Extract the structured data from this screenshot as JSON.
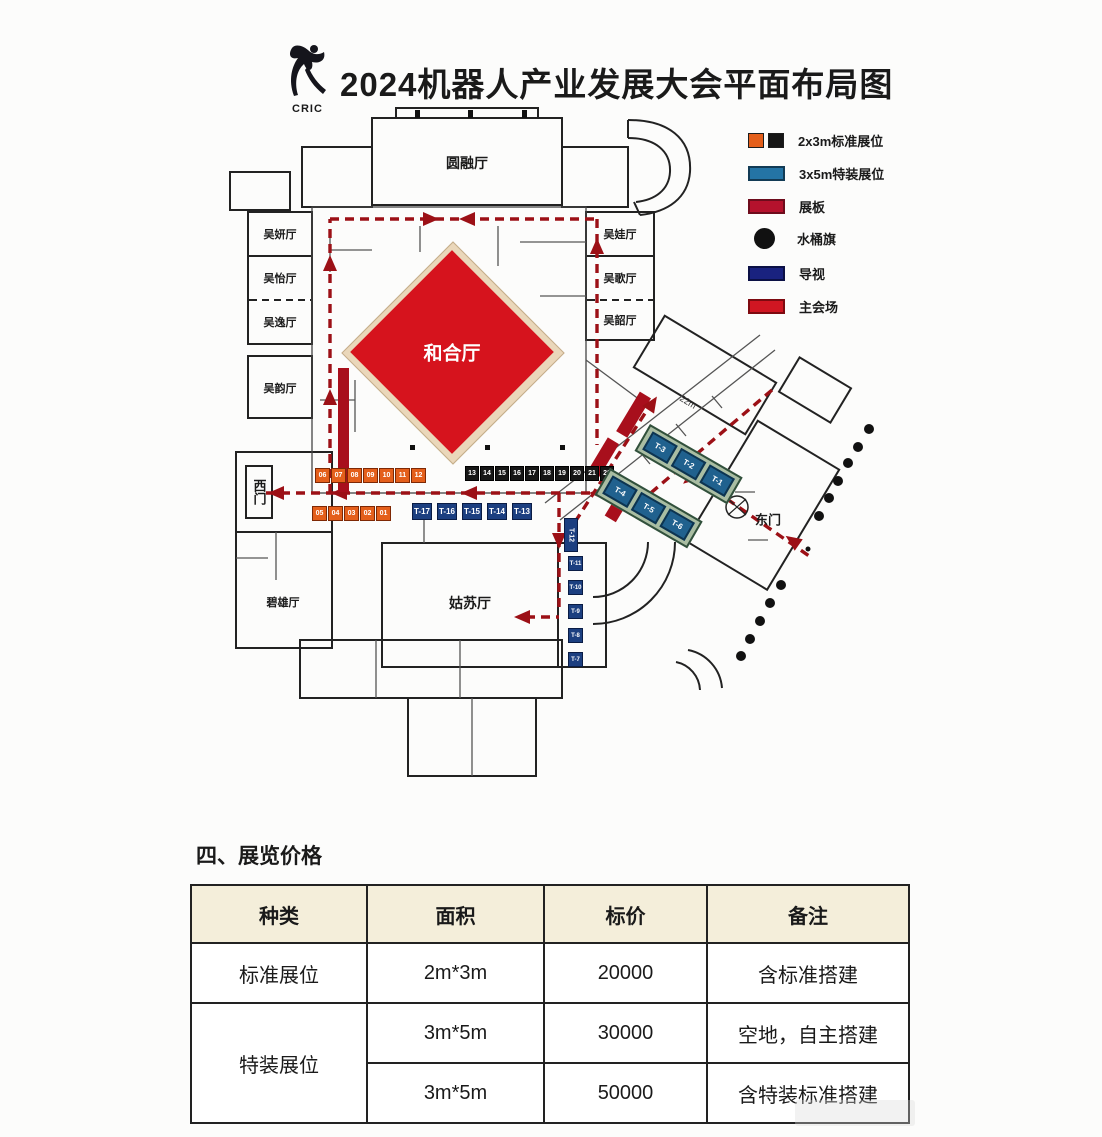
{
  "header": {
    "logo_text": "CRIC",
    "title": "2024机器人产业发展大会平面布局图"
  },
  "legend": {
    "items": [
      {
        "label": "2x3m标准展位",
        "colors": [
          "#e45f1b",
          "#161616"
        ]
      },
      {
        "label": "3x5m特装展位",
        "color": "#2474a5"
      },
      {
        "label": "展板",
        "color": "#b5122d"
      },
      {
        "label": "水桶旗",
        "color": "#111111"
      },
      {
        "label": "导视",
        "color": "#19227f"
      },
      {
        "label": "主会场",
        "color": "#d01622"
      }
    ]
  },
  "floorplan": {
    "rooms": {
      "yuanrong": "圆融厅",
      "hehe": "和合厅",
      "gusu": "姑苏厅",
      "bixiong": "碧雄厅",
      "left": [
        {
          "label": "吴妍厅"
        },
        {
          "label": "吴怡厅"
        },
        {
          "label": "吴逸厅"
        },
        {
          "label": "吴韵厅"
        }
      ],
      "right": [
        {
          "label": "吴娃厅"
        },
        {
          "label": "吴歌厅"
        },
        {
          "label": "吴韶厅"
        }
      ]
    },
    "gates": {
      "west": "西门",
      "east": "东门"
    },
    "booths": {
      "orange_row": [
        "06",
        "07",
        "08",
        "09",
        "10",
        "11",
        "12"
      ],
      "black_row": [
        "13",
        "14",
        "15",
        "16",
        "17",
        "18",
        "19",
        "20",
        "21",
        "22"
      ],
      "orange_row2": [
        "05",
        "04",
        "03",
        "02",
        "01"
      ],
      "blue_row": [
        "T-17",
        "T-16",
        "T-15",
        "T-14",
        "T-13"
      ],
      "blue_t12": "T-12",
      "blue_col": [
        "T-11",
        "T-10",
        "T-9",
        "T-8",
        "T-7"
      ],
      "teal_row1": [
        "T-3",
        "T-2",
        "T-1"
      ],
      "teal_row2": [
        "T-4",
        "T-5",
        "T-6"
      ]
    },
    "dim_label": "22m"
  },
  "pricing": {
    "section_title": "四、展览价格",
    "table": {
      "headers": [
        "种类",
        "面积",
        "标价",
        "备注"
      ],
      "rows": [
        {
          "type": "标准展位",
          "area": "2m*3m",
          "price": "20000",
          "note": "含标准搭建"
        },
        {
          "type": "特装展位",
          "area": "3m*5m",
          "price": "30000",
          "note": "空地，自主搭建"
        },
        {
          "type": "",
          "area": "3m*5m",
          "price": "50000",
          "note": "含特装标准搭建"
        }
      ]
    }
  }
}
